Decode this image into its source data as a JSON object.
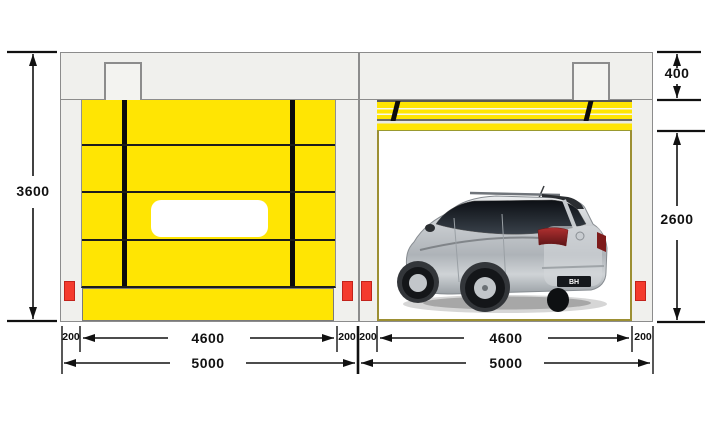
{
  "dimensions": {
    "wall_height": "3600",
    "header_height": "400",
    "door_clear_height": "2600",
    "side_margin": "200",
    "door_clear_width": "4600",
    "unit_width": "5000"
  },
  "colors": {
    "curtain-yellow": "#FFE503",
    "frame-fill": "#F0F0ED",
    "frame-border": "#8C8C8C",
    "seam-black": "#1C1C1C",
    "sensor-red": "#F43B2E",
    "guide-olive": "#9C8F33",
    "dim-ink": "#111111",
    "stripe-dark": "#5A5A58"
  },
  "car": {
    "plate_text": "BH"
  }
}
